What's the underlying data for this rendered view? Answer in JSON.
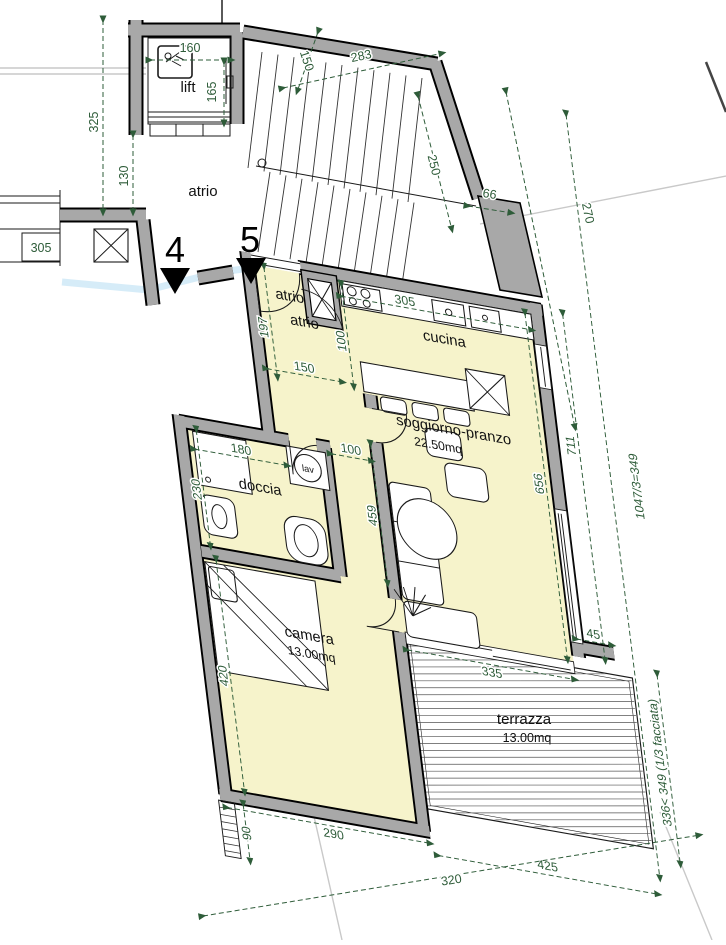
{
  "plan": {
    "units": [
      "4",
      "5"
    ],
    "rooms": {
      "lift": "lift",
      "atrio_stair": "atrio",
      "atrio_entry_a": "atrio",
      "atrio_entry_b": "atrio",
      "cucina": "cucina",
      "soggiorno_name": "soggiorno-pranzo",
      "soggiorno_area": "22.50mq",
      "doccia": "doccia",
      "lav": "lav",
      "camera_name": "camera",
      "camera_area": "13.00mq",
      "terrazza_name": "terrazza",
      "terrazza_area": "13.00mq"
    },
    "dims": {
      "d160": "160",
      "d165": "165",
      "d325": "325",
      "d130": "130",
      "d150_top": "150",
      "d283": "283",
      "d250": "250",
      "d270": "270",
      "d66": "66",
      "d305_box": "305",
      "d305_kitchen": "305",
      "d197": "197",
      "d150_atrio": "150",
      "d100_shaft": "100",
      "d100_corridor": "100",
      "d180": "180",
      "d230": "230",
      "d459": "459",
      "d656": "656",
      "d711": "711",
      "d1047": "1047/3=349",
      "d45": "45",
      "d335": "335",
      "d420": "420",
      "d290": "290",
      "d336": "336< 349 (1/3 facciata)",
      "d90": "90",
      "d320": "320",
      "d425": "425"
    },
    "colors": {
      "wall": "#a8a8a8",
      "floor": "#f6f3cb",
      "dim": "#2e5c39",
      "walkway": "#cfe9f7"
    }
  }
}
